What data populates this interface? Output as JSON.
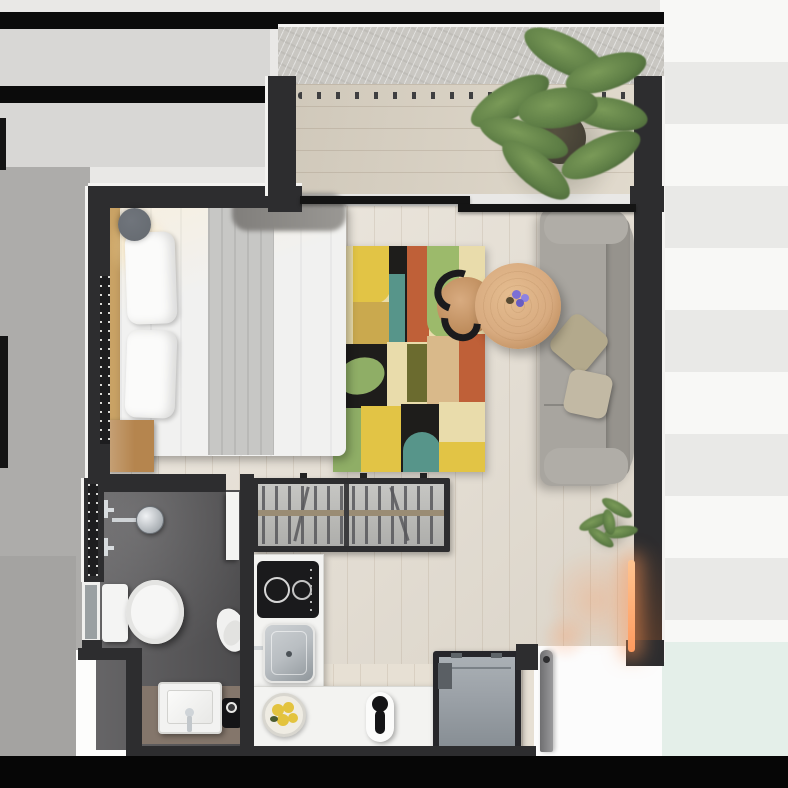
{
  "meta": {
    "title": "Studio apartment floor plan — top-down 3D render",
    "view": "top-down",
    "visible_text": "none"
  },
  "palette": {
    "bg": "#e9e8e6",
    "bg-left": "#adacaa",
    "bg-left2": "#a4a3a1",
    "band-gray": "#d8d7d5",
    "band-black": "#0b0b0b",
    "stripe-a": "#f8f8f6",
    "stripe-b": "#e9e9e7",
    "cyan": "#e4efe9",
    "bottom-band": "#060606",
    "wall": "#2d2d2f",
    "trim": "#f4f3f1",
    "wood": "#e7e0d4",
    "deck": "#ddd5c6",
    "concrete": "#c9c7c2",
    "bath-floor": "#59585a",
    "vanity": "#84766b",
    "counter": "#f3f3f1",
    "steel": "#b9bec2",
    "appliance": "#9ba1a7",
    "cooktop": "#1a1a1c",
    "sofa": "#a8a59f",
    "sofa-back": "#96938d",
    "pillow-a": "#b3a98c",
    "pillow-b": "#c2b9a4",
    "bedding": "#f1f1f0",
    "runner": "#c7c7c5",
    "fur": "#8b8986",
    "headboard": "#c9a265",
    "nightstand": "#b5854e",
    "table": "#d8ab80",
    "table-edge": "#b07c49",
    "chair-black": "#1b1b1d",
    "plant-main": "#5d7d45",
    "plant-dark": "#3f5730",
    "plant-light": "#7a9a58",
    "pot": "#3e3a31",
    "glow": "#ff9a5e",
    "white": "#fbfbfa",
    "glass": "#9aa0a2",
    "fixture": "#64696f",
    "purple": "#7b6fd6",
    "fruit": "#e3c33e",
    "rug-cream": "#e9dcab",
    "rug-yellow": "#e2c445",
    "rug-mustard": "#caa94e",
    "rug-rust": "#bf6038",
    "rug-green": "#9cba6b",
    "rug-teal": "#57958a",
    "rug-black": "#1e1d1b",
    "rug-tan": "#d9b98a",
    "rug-sage": "#8fae66",
    "rug-olive": "#6b6b2f"
  },
  "objects": {
    "balcony": {
      "label": "Balcony with wood deck and concrete ledge"
    },
    "railing": {
      "label": "Balcony railing"
    },
    "plant": {
      "label": "Large potted plant"
    },
    "sliding_door": {
      "label": "Sliding glass door"
    },
    "bed": {
      "label": "Double bed with white bedding"
    },
    "pillows": {
      "label": "Bed pillows"
    },
    "throw": {
      "label": "Fur throw blanket"
    },
    "ceiling_light": {
      "label": "Round ceiling light"
    },
    "nightstand": {
      "label": "Wood nightstand"
    },
    "window": {
      "label": "Bathroom window"
    },
    "rug": {
      "label": "Colorful abstract patchwork rug"
    },
    "coffee_table": {
      "label": "Organic-shaped wood coffee table"
    },
    "chair": {
      "label": "Black bentwood chair"
    },
    "flowers": {
      "label": "Purple flowers in vase"
    },
    "sofa": {
      "label": "Gray sofa"
    },
    "sofa_pillows": {
      "label": "Sofa cushions"
    },
    "floor_plant": {
      "label": "Small floor plant"
    },
    "wardrobe": {
      "label": "Open wardrobe with hangers"
    },
    "cooktop": {
      "label": "Two-burner induction cooktop"
    },
    "kitchen_sink": {
      "label": "Stainless kitchen sink"
    },
    "counter": {
      "label": "L-shaped kitchen counter"
    },
    "fruit_bowl": {
      "label": "Bowl of fruit"
    },
    "kettle": {
      "label": "Kettle / small appliance"
    },
    "washer": {
      "label": "Washing machine"
    },
    "entry_door": {
      "label": "Entry door (open)"
    },
    "shower": {
      "label": "Shower head and valves"
    },
    "toilet": {
      "label": "Toilet"
    },
    "bath_sink": {
      "label": "Square washbasin"
    },
    "vanity": {
      "label": "Bathroom vanity"
    },
    "towel": {
      "label": "Towel"
    },
    "bath_door": {
      "label": "Bathroom door (open)"
    },
    "tray": {
      "label": "Black tray with cup"
    },
    "accent_light": {
      "label": "Warm LED accent light"
    }
  }
}
